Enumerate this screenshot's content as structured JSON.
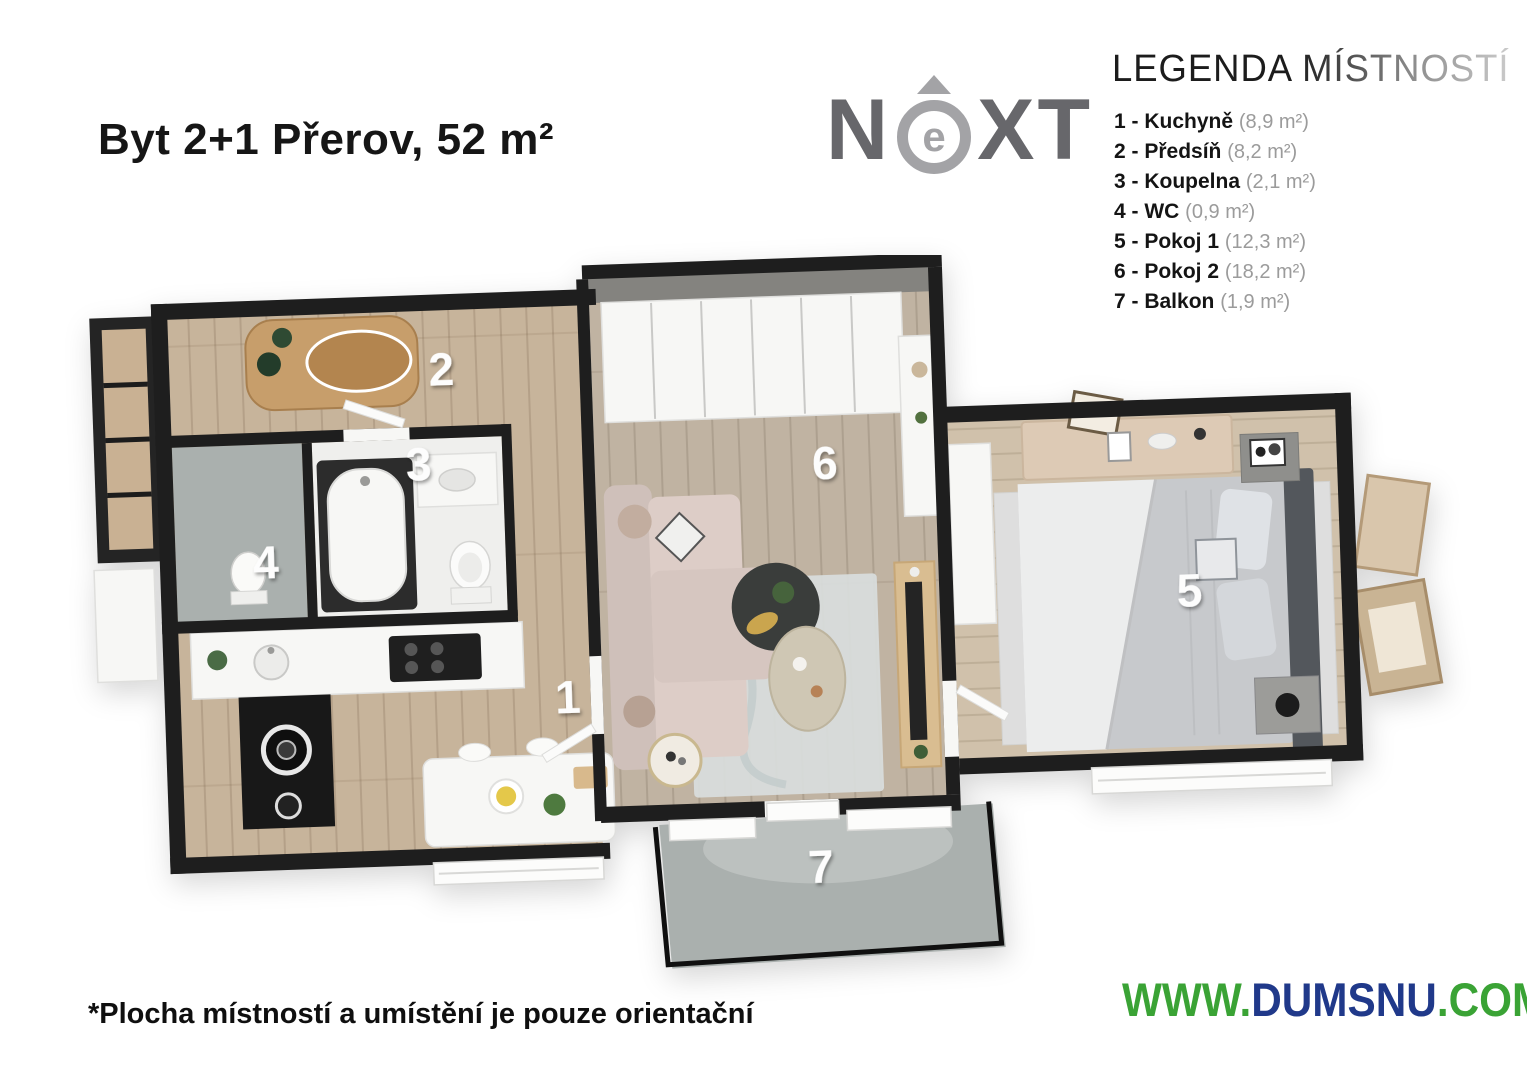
{
  "header": {
    "title": "Byt 2+1 Přerov, 52 m²"
  },
  "logo": {
    "n": "N",
    "e": "e",
    "xt": "XT"
  },
  "legend": {
    "title_word1": "LEGENDA",
    "title_word2": "MÍSTNOSTÍ",
    "items": [
      {
        "label": "1 - Kuchyně",
        "area": "(8,9 m²)"
      },
      {
        "label": "2 - Předsíň",
        "area": "(8,2 m²)"
      },
      {
        "label": "3 - Koupelna",
        "area": "(2,1 m²)"
      },
      {
        "label": "4 - WC",
        "area": "(0,9 m²)"
      },
      {
        "label": "5 - Pokoj 1",
        "area": "(12,3 m²)"
      },
      {
        "label": "6 - Pokoj 2",
        "area": "(18,2 m²)"
      },
      {
        "label": "7 - Balkon",
        "area": "(1,9 m²)"
      }
    ]
  },
  "plan": {
    "rooms": [
      {
        "number": "1",
        "name": "Kuchyně"
      },
      {
        "number": "2",
        "name": "Předsíň"
      },
      {
        "number": "3",
        "name": "Koupelna"
      },
      {
        "number": "4",
        "name": "WC"
      },
      {
        "number": "5",
        "name": "Pokoj 1"
      },
      {
        "number": "6",
        "name": "Pokoj 2"
      },
      {
        "number": "7",
        "name": "Balkon"
      }
    ]
  },
  "footer": {
    "disclaimer": "*Plocha místností a umístění je pouze orientační",
    "site": {
      "www": "WWW.",
      "name": "DUMSNU",
      "tld": ".COM"
    }
  },
  "colors": {
    "green": "#3aa335",
    "navy": "#20398a",
    "wall": "#1e1e1e",
    "wood_hall": "#c7b49b",
    "wood_living": "#c0b3a2",
    "wood_bedroom": "#d0c1ab",
    "concrete": "#aab0ae"
  }
}
